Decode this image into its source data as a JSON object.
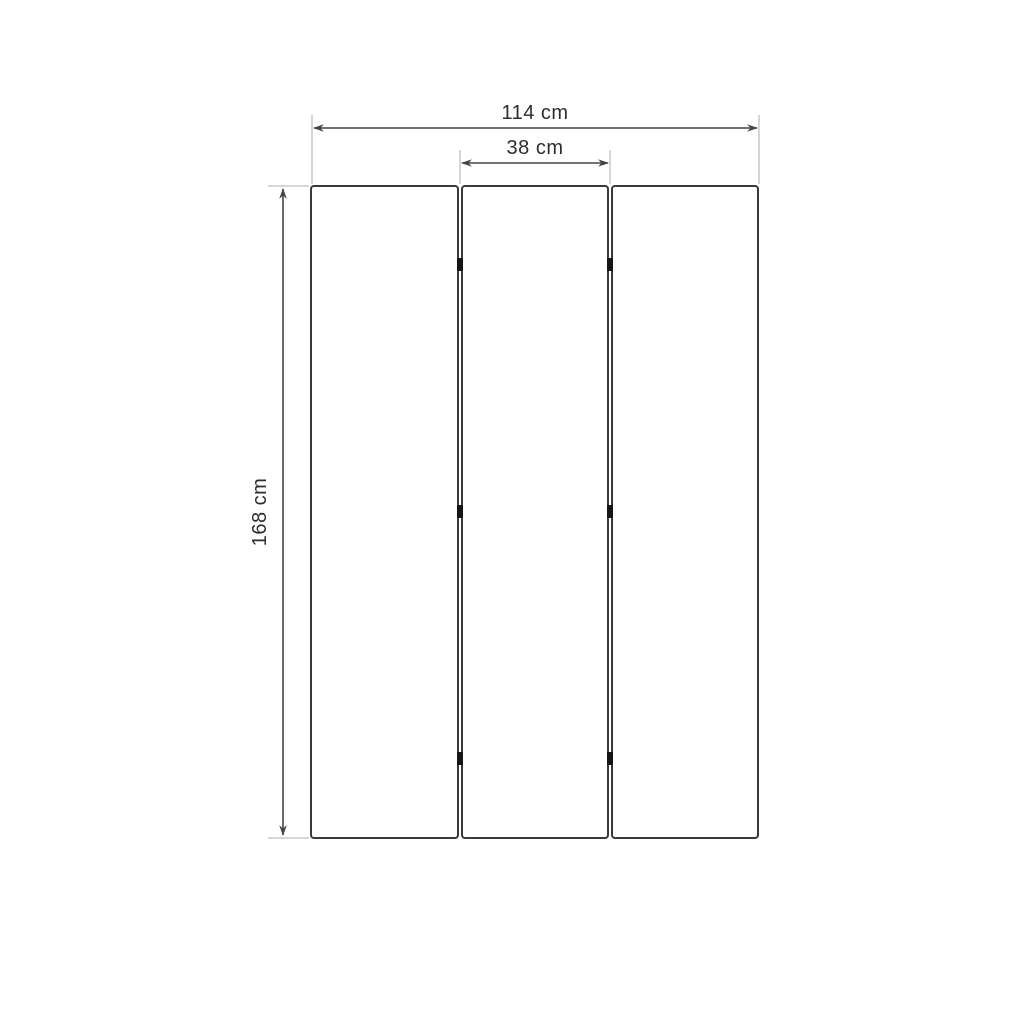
{
  "diagram": {
    "subject": "three-panel folding screen front elevation with dimensions",
    "panel_count": 3,
    "hinge_count": 6,
    "dimensions": {
      "total_width": {
        "label": "114 cm",
        "value": 114,
        "unit": "cm"
      },
      "panel_width": {
        "label": "38 cm",
        "value": 38,
        "unit": "cm"
      },
      "height": {
        "label": "168 cm",
        "value": 168,
        "unit": "cm"
      }
    },
    "colors": {
      "background": "#ffffff",
      "panel_outline": "#3a3a3a",
      "dimension_line": "#444444",
      "extension_line": "#ababab",
      "hinge": "#161616",
      "label_text": "#2d2d2d"
    }
  }
}
